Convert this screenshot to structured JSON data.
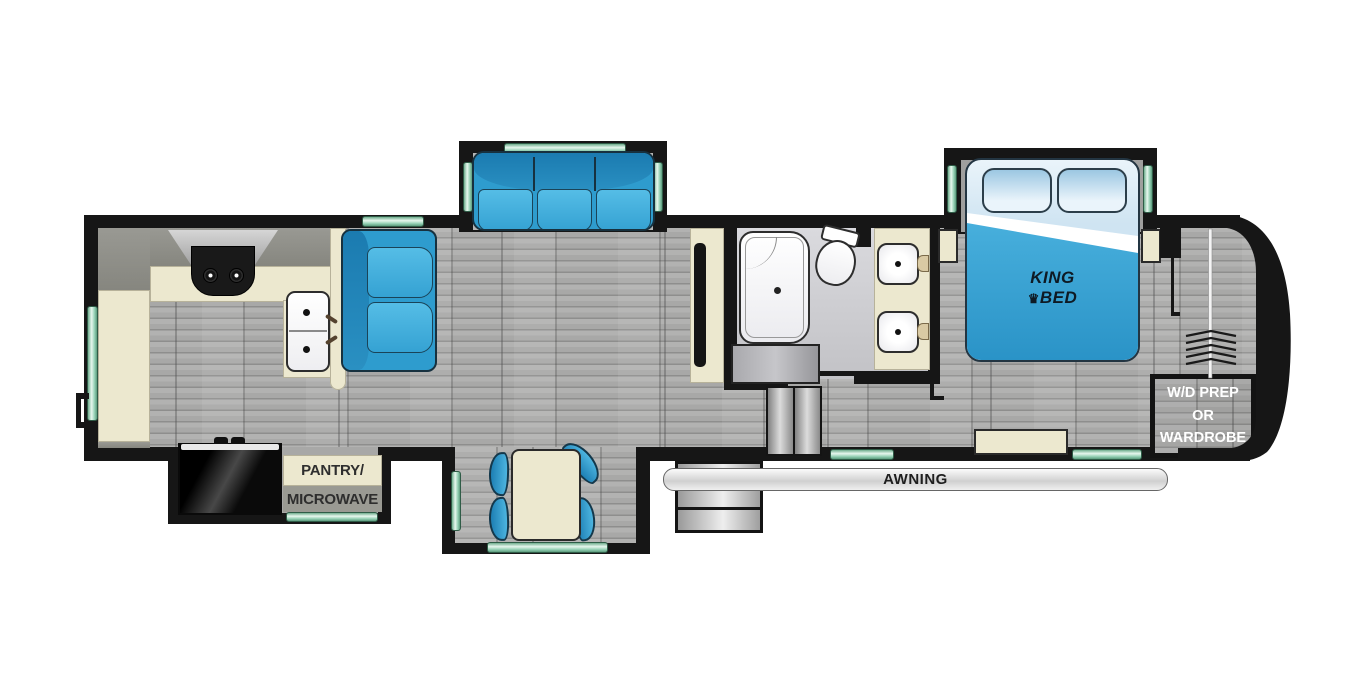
{
  "floorplan": {
    "type": "rv-fifth-wheel-floorplan",
    "labels": {
      "king_bed_line1": "KING",
      "king_bed_line2": "BED",
      "crown_glyph": "♛",
      "pantry_line1": "PANTRY/",
      "pantry_line2": "MICROWAVE",
      "awning": "AWNING",
      "wd_line1": "W/D PREP",
      "wd_line2": "OR",
      "wd_line3": "WARDROBE"
    },
    "colors": {
      "wall": "#161616",
      "furniture_blue": "#35a2d3",
      "furniture_blue_dark": "#1b7bb0",
      "counter_cream": "#ece8cf",
      "window_green": "#8fcdb0",
      "floor_gray": "#a8a8a7",
      "bath_floor": "#cdcdd1",
      "bed_blanket": "#3aa7d8",
      "text_dark": "#2e2e2e",
      "text_light": "#ffffff"
    },
    "rooms": [
      "kitchen",
      "living-area",
      "dinette",
      "bathroom",
      "bedroom",
      "front-wardrobe"
    ],
    "furniture": [
      "range-with-hood",
      "double-kitchen-sink",
      "refrigerator",
      "pantry-microwave-cabinet",
      "loveseat",
      "theater-sofa",
      "tv-cabinet",
      "dinette-table",
      "dinette-chairs",
      "shower",
      "toilet",
      "double-vanity-sinks",
      "king-bed",
      "nightstands",
      "bedroom-dresser",
      "wardrobe-hanging-rod",
      "entry-steps",
      "awning"
    ]
  }
}
